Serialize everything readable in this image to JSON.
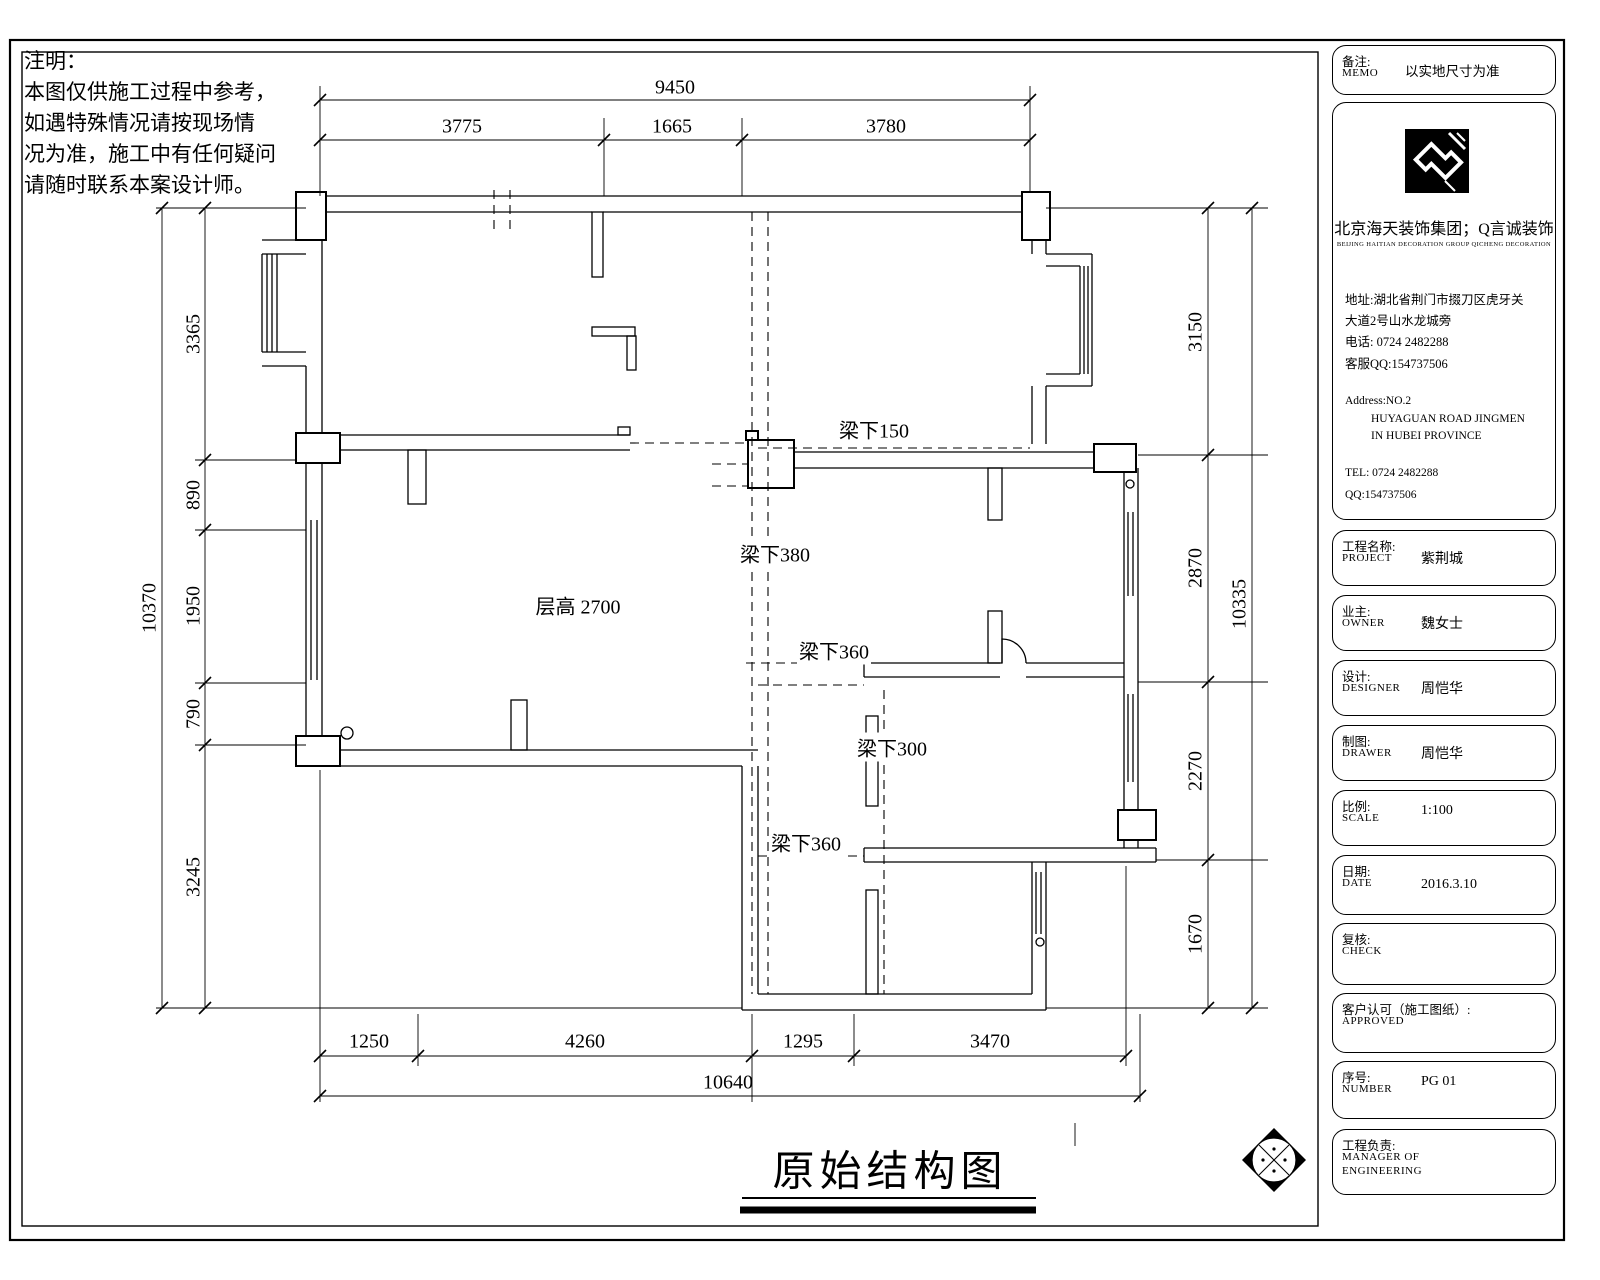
{
  "colors": {
    "line": "#000000",
    "background": "#ffffff"
  },
  "notes": {
    "title": "注明：",
    "line1": "本图仅供施工过程中参考，",
    "line2": "如遇特殊情况请按现场情",
    "line3": "况为准，施工中有任何疑问",
    "line4": "请随时联系本案设计师。"
  },
  "plan": {
    "beam150": "梁下150",
    "beam380": "梁下380",
    "beam360a": "梁下360",
    "beam300": "梁下300",
    "beam360b": "梁下360",
    "floor_height": "层高 2700"
  },
  "dims": {
    "top_total": "9450",
    "top": [
      "3775",
      "1665",
      "3780"
    ],
    "left_total": "10370",
    "left": [
      "3365",
      "890",
      "1950",
      "790",
      "3245"
    ],
    "right_total": "10335",
    "right": [
      "3150",
      "2870",
      "2270",
      "1670"
    ],
    "bottom_total": "10640",
    "bottom": [
      "1250",
      "4260",
      "1295",
      "3470"
    ]
  },
  "drawing_title": "原始结构图",
  "titleblock": {
    "memo": {
      "label": "备注:",
      "label_en": "MEMO",
      "value": "以实地尺寸为准"
    },
    "company": {
      "name": "北京海天装饰集团；Q言诚装饰",
      "name_en": "BEIJING HAITIAN DECORATION GROUP QICHENG DECORATION",
      "addr1": "地址:湖北省荆门市掇刀区虎牙关",
      "addr2": "大道2号山水龙城旁",
      "tel_cn": "电话: 0724 2482288",
      "qq_cn": "客服QQ:154737506",
      "addr_en1": "Address:NO.2",
      "addr_en2": "HUYAGUAN ROAD JINGMEN",
      "addr_en3": "IN HUBEI PROVINCE",
      "tel_en": "TEL: 0724 2482288",
      "qq_en": "QQ:154737506"
    },
    "rows": [
      {
        "label": "工程名称:",
        "label_en": "PROJECT",
        "value": "紫荆城"
      },
      {
        "label": "业主:",
        "label_en": "OWNER",
        "value": "魏女士"
      },
      {
        "label": "设计:",
        "label_en": "DESIGNER",
        "value": "周恺华"
      },
      {
        "label": "制图:",
        "label_en": "DRAWER",
        "value": "周恺华"
      },
      {
        "label": "比例:",
        "label_en": "SCALE",
        "value": "1:100"
      },
      {
        "label": "日期:",
        "label_en": "DATE",
        "value": "2016.3.10"
      },
      {
        "label": "复核:",
        "label_en": "CHECK",
        "value": ""
      },
      {
        "label": "客户认可（施工图纸）:",
        "label_en": "APPROVED",
        "value": ""
      },
      {
        "label": "序号:",
        "label_en": "NUMBER",
        "value": "PG  01"
      },
      {
        "label": "工程负责:",
        "label_en": "MANAGER OF",
        "label_en2": "ENGINEERING",
        "value": ""
      }
    ]
  }
}
